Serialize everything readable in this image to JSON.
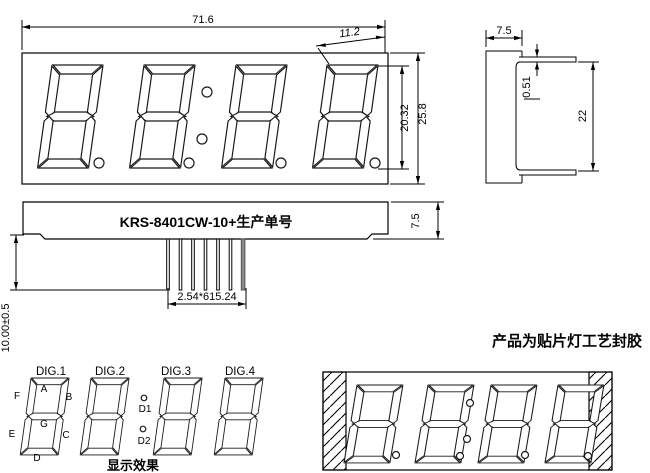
{
  "drawing": {
    "front_view": {
      "dim_total_width": "71.6",
      "dim_digit_width": "11.2",
      "dim_digit_height": "20.32",
      "dim_total_height": "25.8"
    },
    "side_view": {
      "dim_depth": "7.5",
      "dim_pin_thickness": "0.51",
      "dim_pin_span": "22"
    },
    "back_view": {
      "part_label": "KRS-8401CW-10+生产单号",
      "dim_body_thickness": "7.5",
      "dim_pin_length": "10.00±0.5",
      "dim_pin_pitch": "2.54*615.24"
    },
    "segment_diagram": {
      "digit_labels": [
        "DIG.1",
        "DIG.2",
        "DIG.3",
        "DIG.4"
      ],
      "segment_labels": {
        "a": "A",
        "b": "B",
        "c": "C",
        "d": "D",
        "e": "E",
        "f": "F",
        "g": "G"
      },
      "dot_labels": {
        "d1": "D1",
        "d2": "D2"
      },
      "caption": "显示效果"
    },
    "package_view": {
      "caption": "产品为贴片灯工艺封胶"
    },
    "colors": {
      "line": "#000000",
      "background": "#ffffff",
      "pin_gray": "#8a8a8a"
    }
  }
}
